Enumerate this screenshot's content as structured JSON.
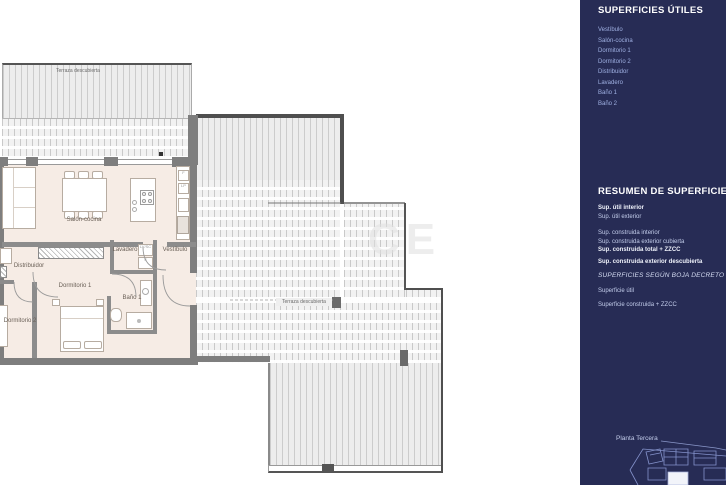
{
  "plan": {
    "room_labels": {
      "terrace_top": "Terraza descubierta",
      "salon": "Salón-cocina",
      "distribuidor": "Distribuidor",
      "dormitorio1": "Dormitorio 1",
      "dormitorio2": "Dormitorio 2",
      "lavadero": "Lavadero",
      "vestibulo": "Vestíbulo",
      "bano1": "Baño 1",
      "terrace_main": "Terraza descubierta"
    },
    "appliance_labels": {
      "washer": "LV/SC",
      "dryer": "S",
      "fridge": "F",
      "pantry": "LP"
    },
    "watermark": "CE"
  },
  "sidebar": {
    "title": "SUPERFICIES ÚTILES",
    "rooms": [
      "Vestíbulo",
      "Salón-cocina",
      "Dormitorio 1",
      "Dormitorio 2",
      "Distribuidor",
      "Lavadero",
      "Baño 1",
      "Baño 2"
    ],
    "resumen_title": "RESUMEN  DE SUPERFICIES",
    "resumen_lines": [
      "Sup. útil interior",
      "Sup. útil exterior",
      "Sup. construida interior",
      "Sup. construida exterior cubierta",
      "Sup. construida total + ZZCC",
      "Sup. construida exterior descubierta"
    ],
    "decreto_title": "SUPERFICIES SEGÚN BOJA DECRETO",
    "decreto_lines": [
      "Superficie útil",
      "Superficie construida + ZZCC"
    ],
    "floor_label": "Planta Tercera",
    "colors": {
      "sidebar_bg": "#272c55",
      "item_text": "#9fb0e2",
      "floor_fill": "#f6ece5",
      "wall_gray": "#7e7e7e"
    }
  }
}
